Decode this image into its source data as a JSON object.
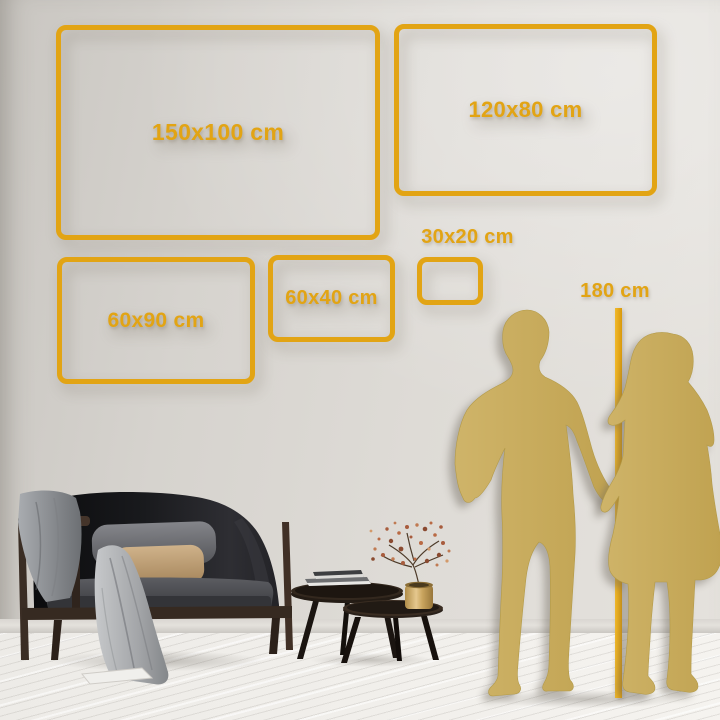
{
  "image_type": "wall-art size comparison guide",
  "colors": {
    "accent_gold": "#E2A414",
    "silhouette_gold": "#C8AD5E",
    "wall": "#DBD8D3",
    "floor": "#F1EFEB"
  },
  "frames": [
    {
      "label": "150x100 cm"
    },
    {
      "label": "120x80 cm"
    },
    {
      "label": "60x90 cm"
    },
    {
      "label": "60x40 cm"
    },
    {
      "label": "30x20 cm"
    }
  ],
  "height_reference": {
    "label": "180 cm"
  },
  "illustrations": [
    "man-silhouette",
    "woman-silhouette",
    "sofa",
    "gray-blanket",
    "gray-pillow",
    "tan-pillow",
    "coffee-tables",
    "books",
    "brass-vase-plant"
  ]
}
